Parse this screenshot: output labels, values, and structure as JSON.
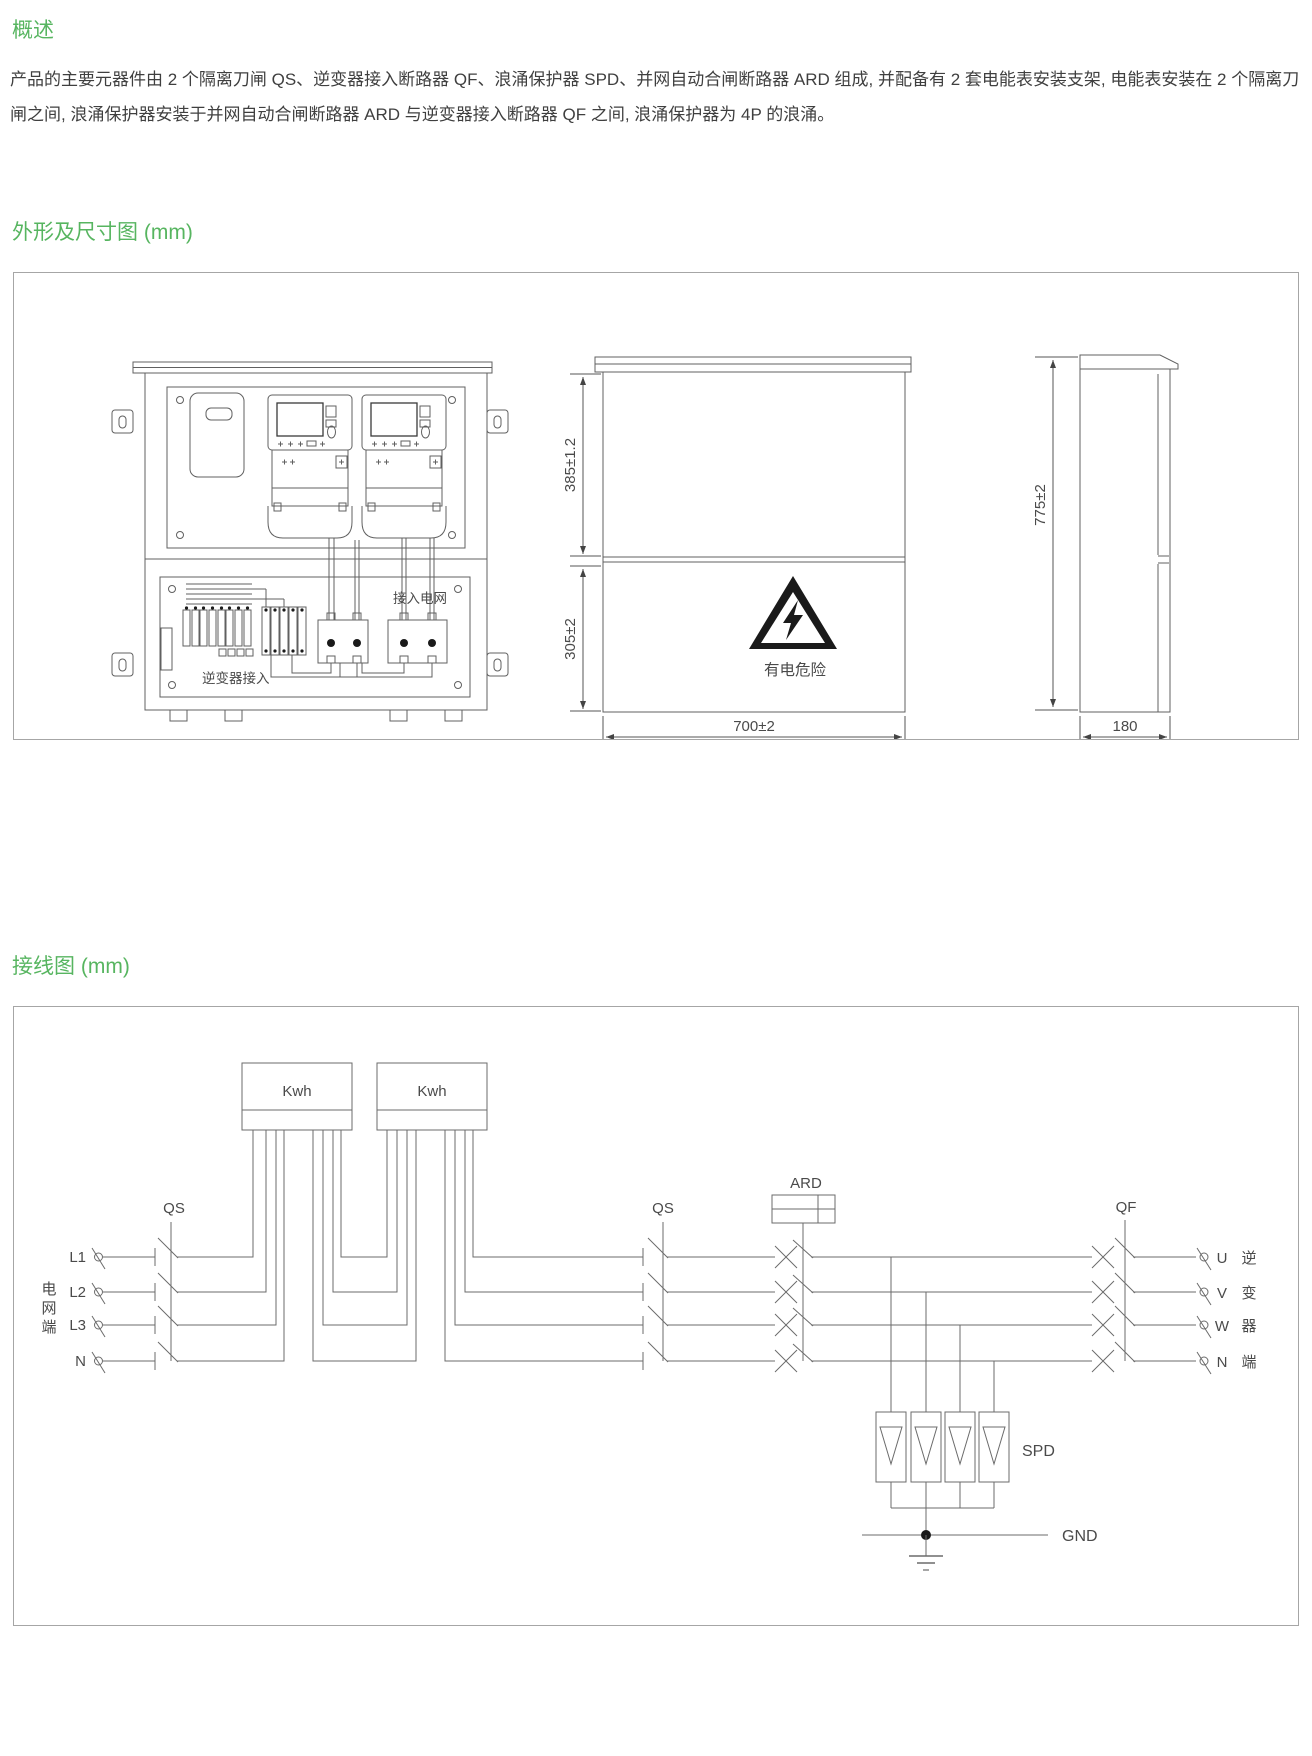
{
  "colors": {
    "heading_green": "#57b560",
    "body_text": "#3f3f3f",
    "diagram_line": "#6b6b6b",
    "diagram_text": "#4a4a4a",
    "box_border": "#a6a6a6",
    "warning_black": "#1a1a1a"
  },
  "overview": {
    "heading": "概述",
    "body": "产品的主要元器件由 2 个隔离刀闸 QS、逆变器接入断路器 QF、浪涌保护器 SPD、并网自动合闸断路器 ARD 组成, 并配备有 2 套电能表安装支架, 电能表安装在 2 个隔离刀闸之间, 浪涌保护器安装于并网自动合闸断路器 ARD 与逆变器接入断路器 QF 之间, 浪涌保护器为 4P 的浪涌。"
  },
  "outline_section": {
    "heading": "外形及尺寸图 (mm)",
    "labels": {
      "grid_in": "接入电网",
      "inverter_in": "逆变器接入",
      "warning": "有电危险"
    },
    "dims": {
      "upper_height": "385±1.2",
      "lower_height": "305±2",
      "width": "700±2",
      "total_height": "775±2",
      "depth": "180"
    }
  },
  "wiring_section": {
    "heading": "接线图 (mm)",
    "meters": [
      "Kwh",
      "Kwh"
    ],
    "switch1": "QS",
    "switch2": "QS",
    "recloser": "ARD",
    "breaker": "QF",
    "surge": "SPD",
    "ground": "GND",
    "grid_terminals": [
      "L1",
      "L2",
      "L3",
      "N"
    ],
    "grid_side_chars": [
      "电",
      "网",
      "端"
    ],
    "inverter_terminals": [
      "U",
      "V",
      "W",
      "N"
    ],
    "inverter_side_chars": [
      "逆",
      "变",
      "器",
      "端"
    ]
  }
}
